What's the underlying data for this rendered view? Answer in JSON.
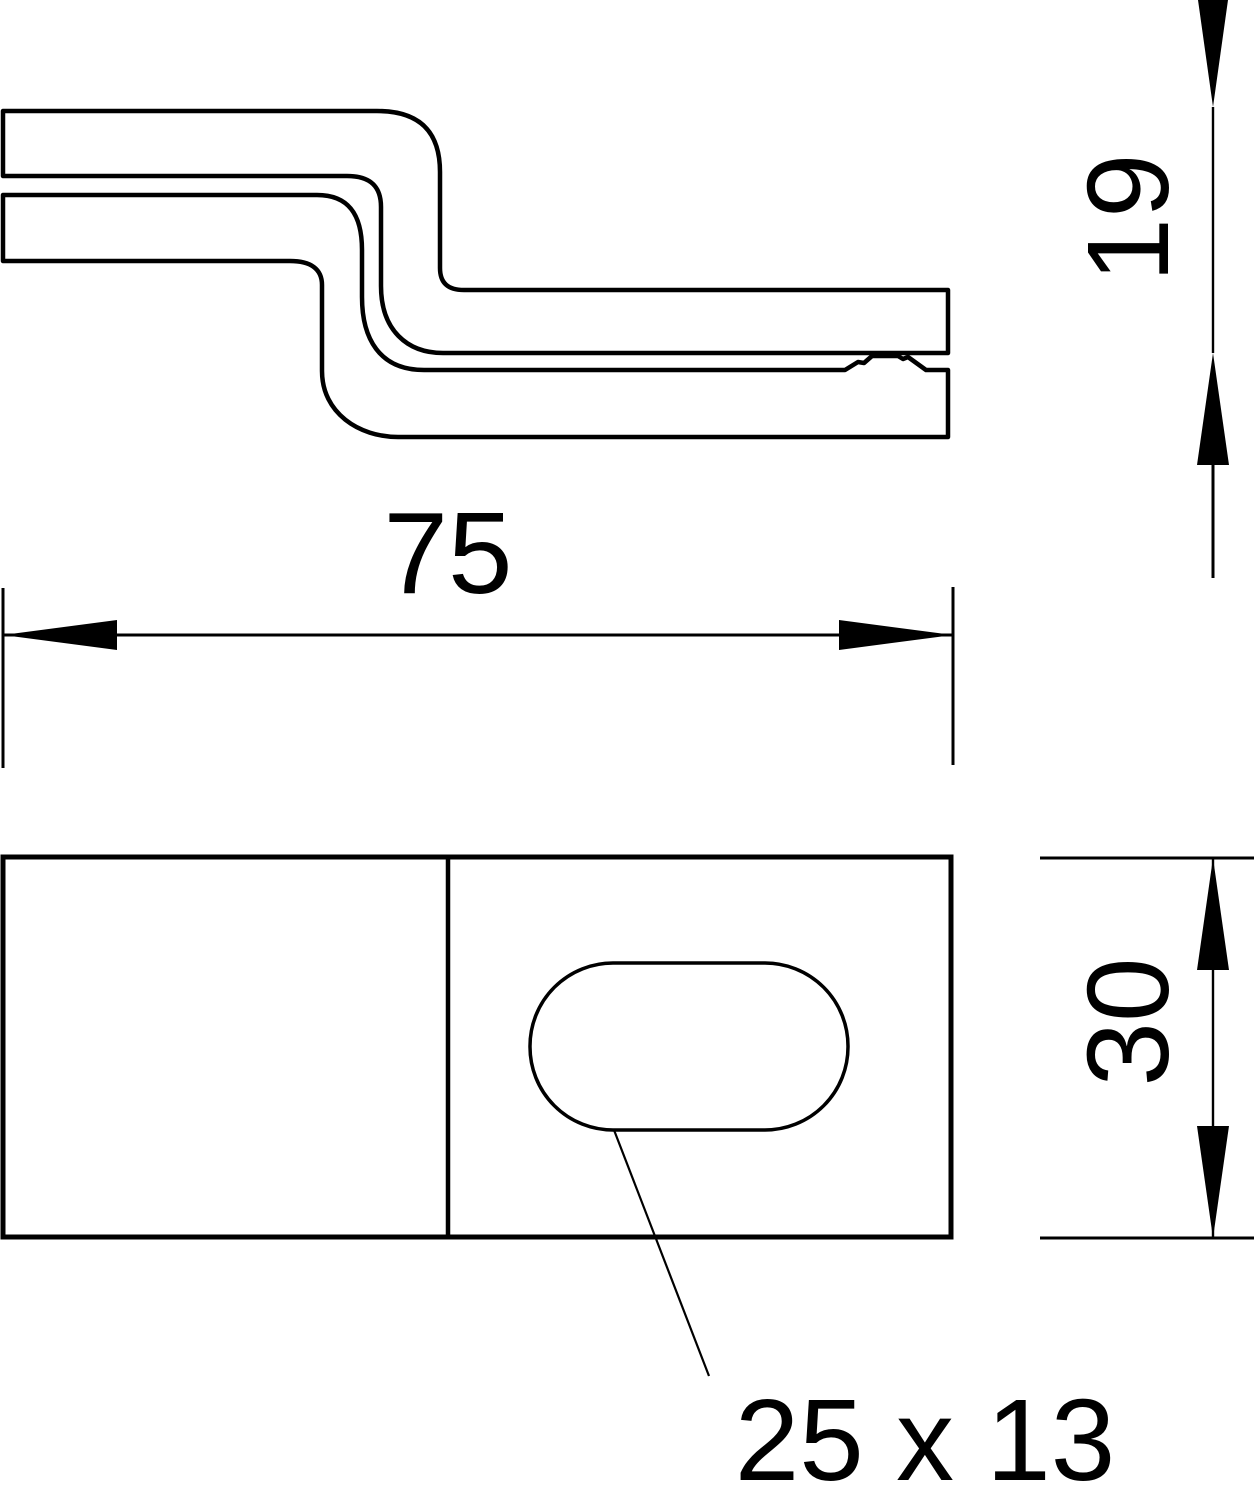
{
  "colors": {
    "line": "#000000",
    "background": "#ffffff"
  },
  "dimensions": {
    "width": {
      "label": "75"
    },
    "height": {
      "label": "19"
    },
    "depth": {
      "label": "30"
    },
    "slot": {
      "label": "25 x 13"
    }
  }
}
